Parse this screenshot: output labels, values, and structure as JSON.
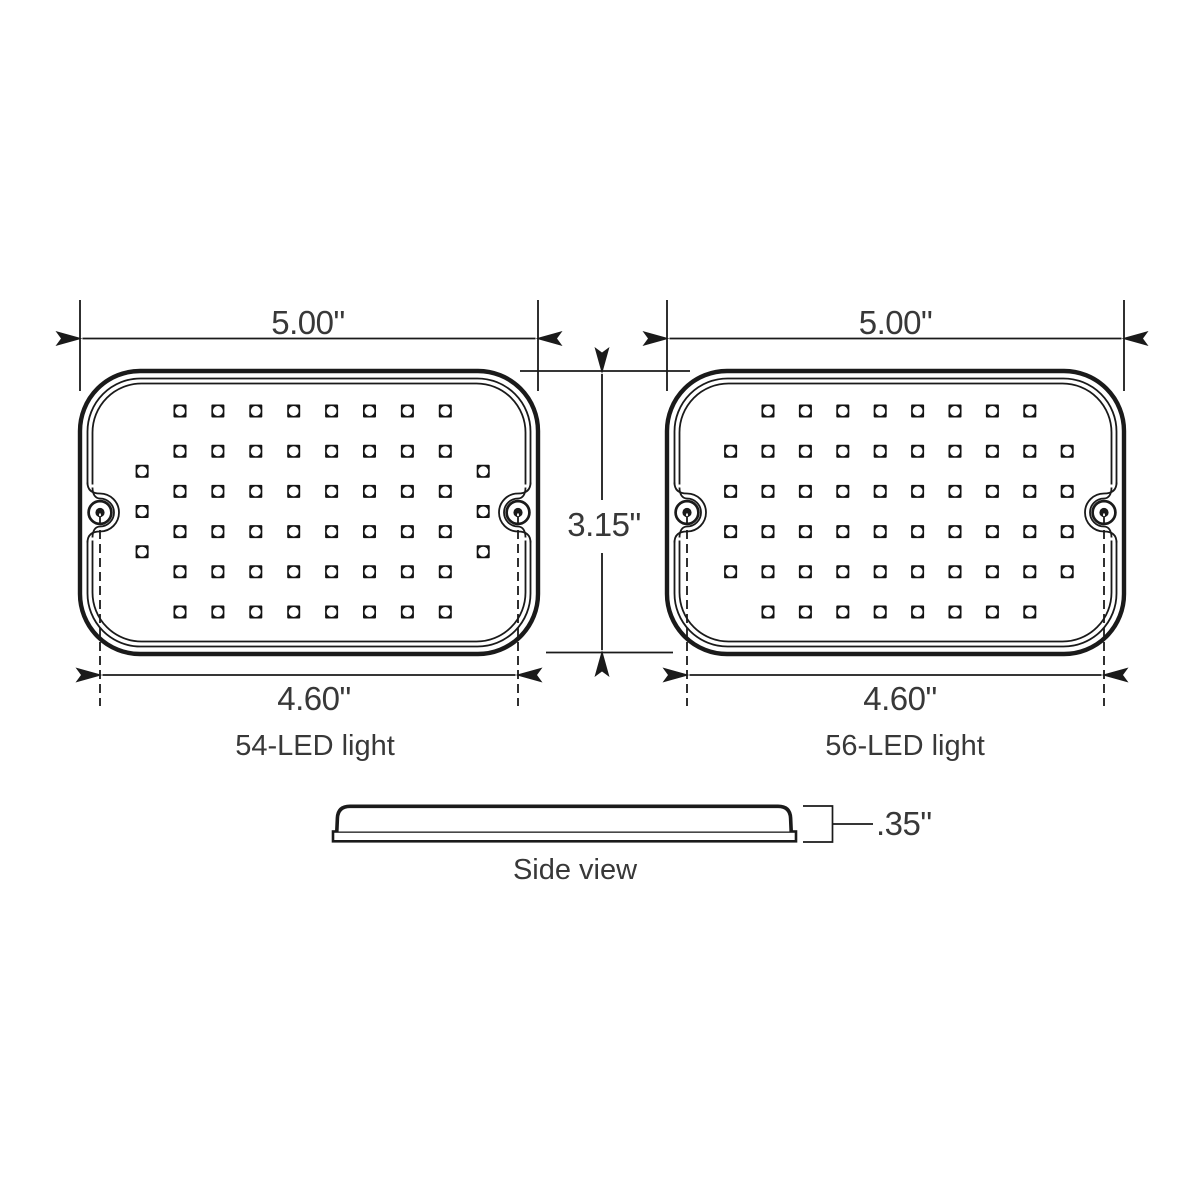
{
  "diagram": {
    "background": "#ffffff",
    "line_color": "#1a1a1a",
    "text_color": "#383838",
    "lights": [
      {
        "label": "54-LED light",
        "led_count": 54,
        "overall_width": "5.00\"",
        "mount_hole_span": "4.60\"",
        "led_pattern": {
          "grid_cols": 8,
          "grid_rows": 6,
          "extra_col_rows": [
            1.5,
            2.5,
            3.5
          ]
        }
      },
      {
        "label": "56-LED light",
        "led_count": 56,
        "overall_width": "5.00\"",
        "mount_hole_span": "4.60\"",
        "led_pattern": {
          "grid_cols": 8,
          "grid_rows": 6,
          "extra_col_rows": [
            1,
            2,
            3,
            4
          ]
        }
      }
    ],
    "height_label": "3.15\"",
    "side_view": {
      "label": "Side view",
      "thickness": ".35\""
    }
  }
}
